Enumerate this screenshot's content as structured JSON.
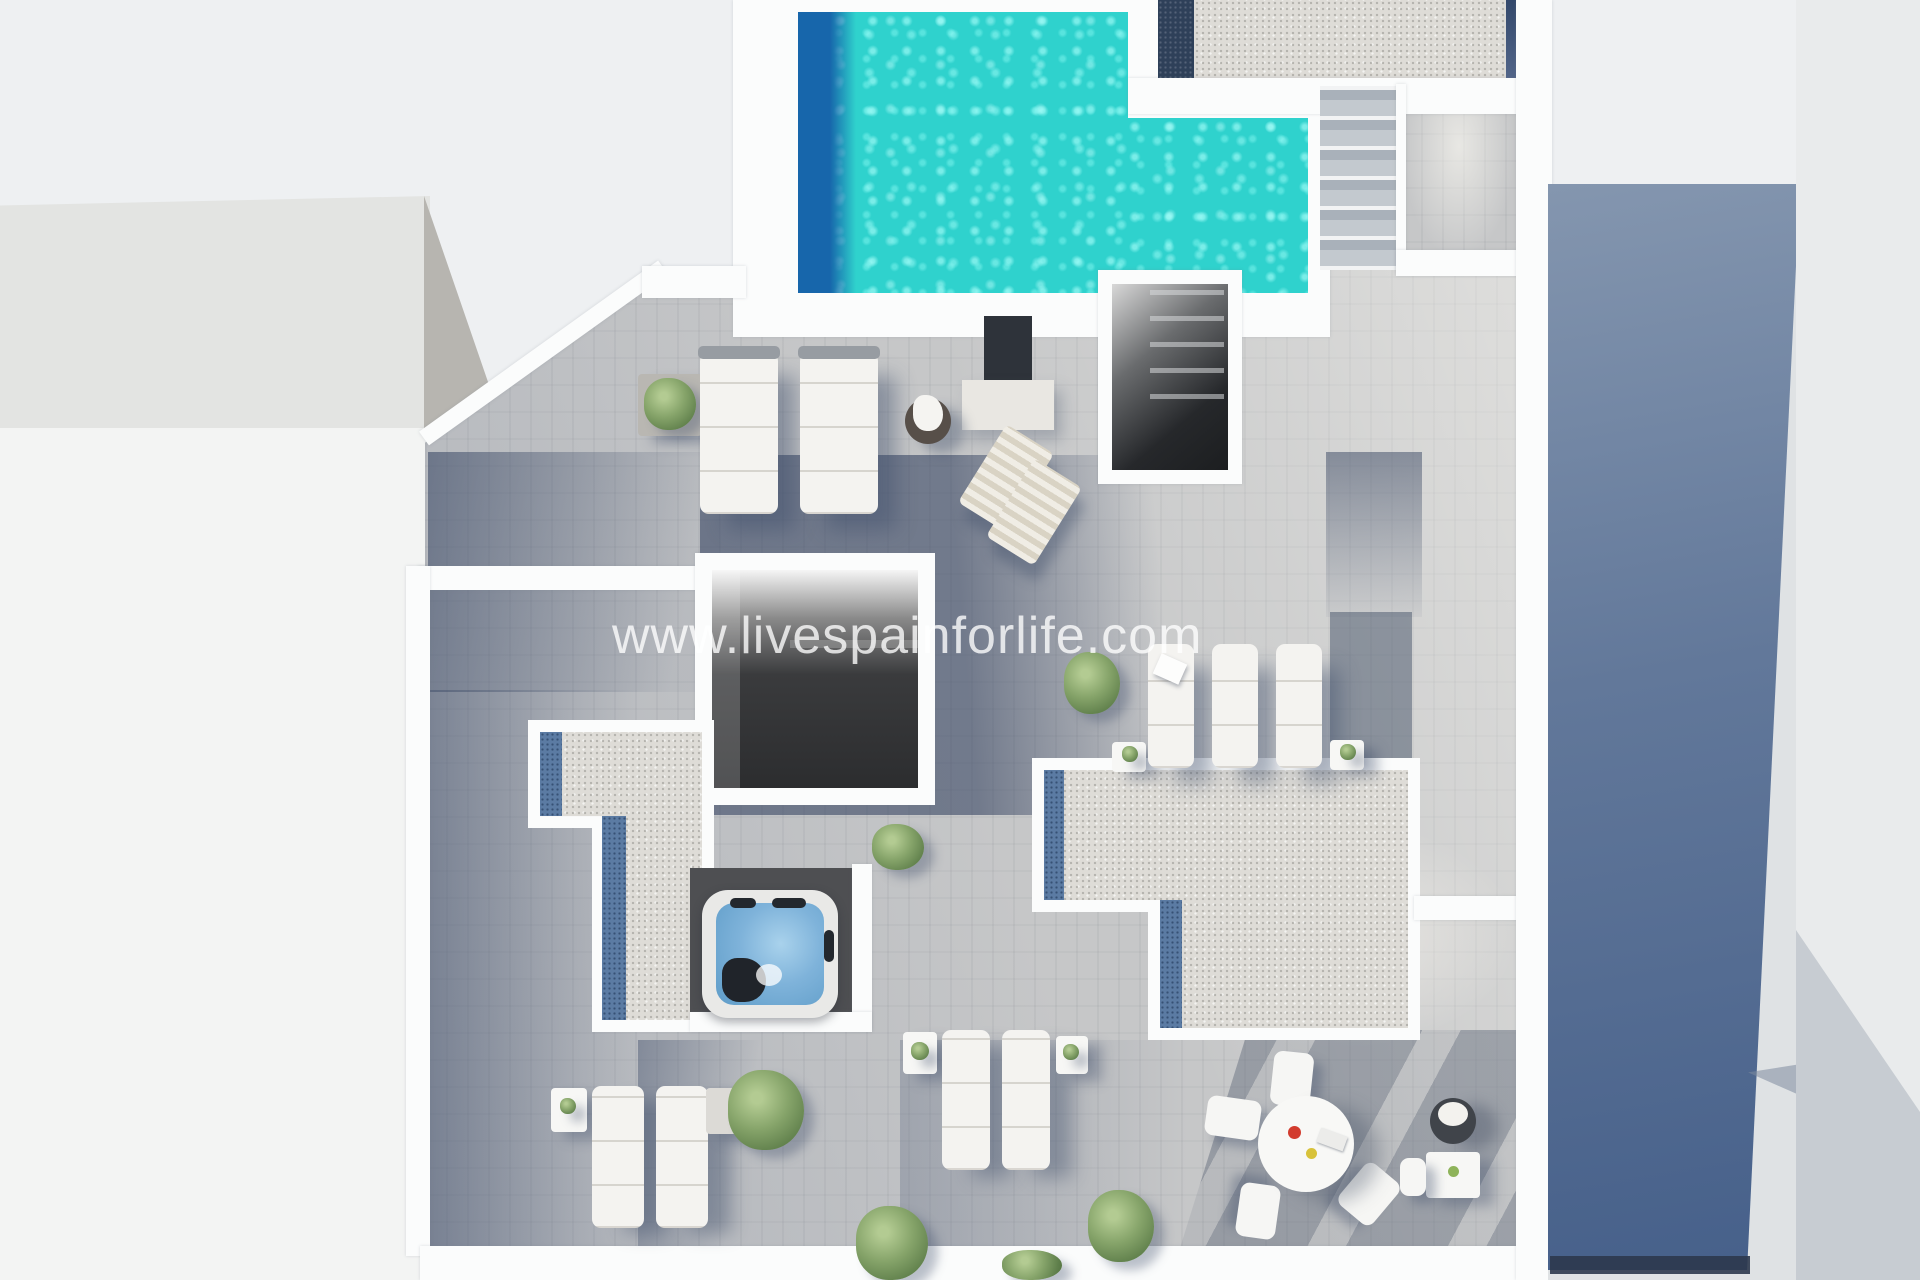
{
  "watermark": {
    "text": "www.livespainforlife.com"
  },
  "palette": {
    "page_bg": "#eef0f2",
    "wall_white": "#fbfcfc",
    "deck_light": "#c6c7c8",
    "deck_shadow": "#566685",
    "pool_turquoise": "#2fd2cd",
    "pool_deep_blue": "#1766ab",
    "gravel_light": "#dedcd7",
    "gravel_blue": "#5b7ba3",
    "hot_tub_water": "#7fb3da",
    "plant_green": "#86a46a",
    "building_gray": "#e3e4e2",
    "building_edge_gray": "#b7b5b0",
    "dark_interior": "#26282b",
    "blue_wall_top": "#8496af",
    "blue_wall_bottom": "#46608a"
  }
}
